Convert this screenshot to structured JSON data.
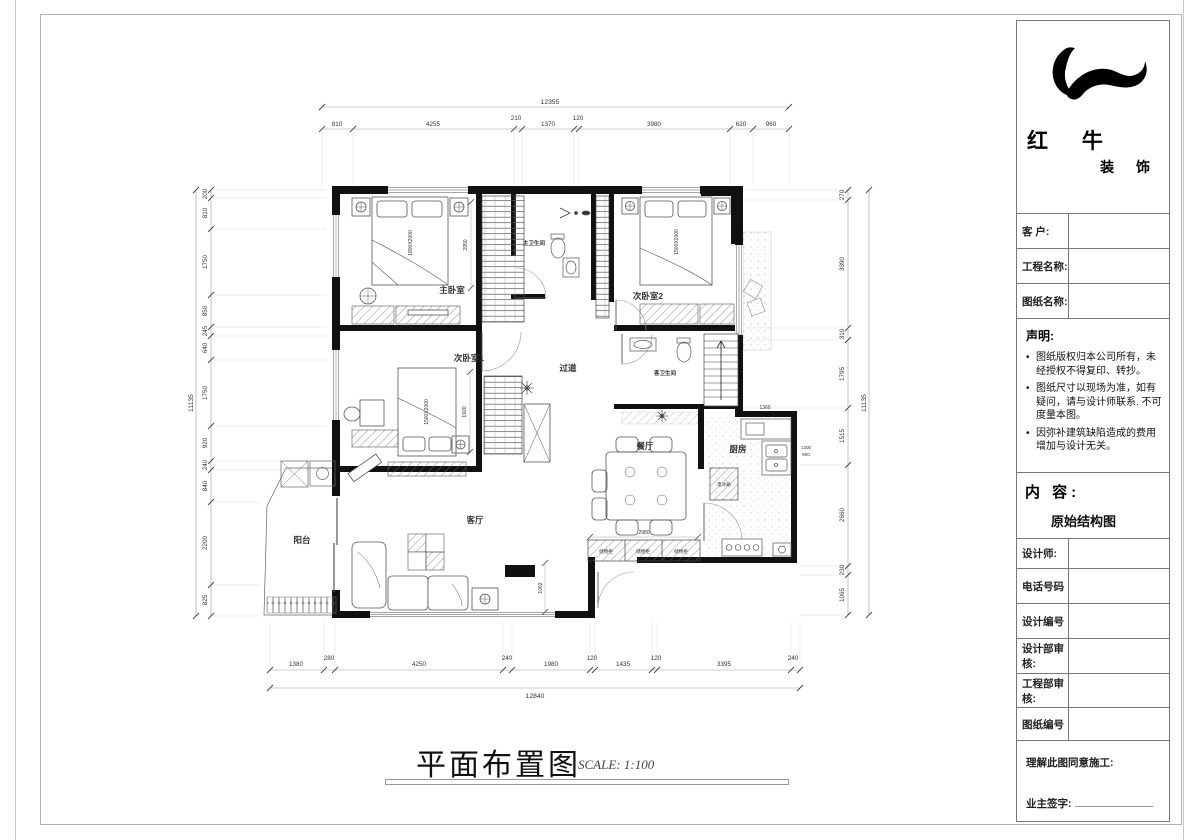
{
  "title_block": {
    "brand_main": "红 牛",
    "brand_sub": "装 饰",
    "client_label": "客  户:",
    "project_label": "工程名称:",
    "drawing_label": "图纸名称:",
    "bullet": "•",
    "statement_heading": "声明:",
    "statement_items": [
      "图纸版权归本公司所有，未经授权不得复印、转抄。",
      "图纸尺寸以现场为准，如有疑问，请与设计师联系. 不可度量本图。",
      "因弥补建筑缺陷造成的费用增加与设计无关。"
    ],
    "content_heading": "内 容:",
    "content_value": "原始结构图",
    "rows": [
      {
        "label": "设计师:"
      },
      {
        "label": "电话号码"
      },
      {
        "label": "设计编号"
      },
      {
        "label": "设计部审核:"
      },
      {
        "label": "工程部审核:"
      },
      {
        "label": "图纸编号"
      }
    ],
    "agree_text": "理解此图同意施工:",
    "sign_label": "业主签字:"
  },
  "footer": {
    "title": "平面布置图",
    "scale": "SCALE: 1:100"
  },
  "plan": {
    "rooms": [
      {
        "label": "主卧室"
      },
      {
        "label": "次卧室2"
      },
      {
        "label": "次卧室1"
      },
      {
        "label": "过道"
      },
      {
        "label": "主卫生间"
      },
      {
        "label": "客卫生间"
      },
      {
        "label": "餐厅"
      },
      {
        "label": "厨房"
      },
      {
        "label": "客厅"
      },
      {
        "label": "阳台"
      }
    ],
    "furniture_labels": {
      "bed_master": "1800X2000",
      "bed2": "1500X2000",
      "bed1": "1500X2000",
      "storage": "储物柜",
      "fridge": "电冰箱"
    },
    "dims": {
      "top_total": "12355",
      "top": [
        "810",
        "4255",
        "210",
        "1370",
        "120",
        "3980",
        "620",
        "960"
      ],
      "bottom_total": "12840",
      "bottom": [
        "1380",
        "280",
        "4250",
        "240",
        "1980",
        "120",
        "1435",
        "120",
        "3395",
        "240"
      ],
      "left_total": "11135",
      "left": [
        "200",
        "810",
        "1750",
        "850",
        "245",
        "640",
        "1750",
        "920",
        "240",
        "840",
        "2200",
        "825"
      ],
      "right_total": "11135",
      "right": [
        "270",
        "3390",
        "310",
        "1795",
        "1515",
        "2660",
        "230",
        "1065"
      ],
      "inner": [
        "2950",
        "1920",
        "2980",
        "1360",
        "1062",
        "1300",
        "900"
      ]
    }
  }
}
